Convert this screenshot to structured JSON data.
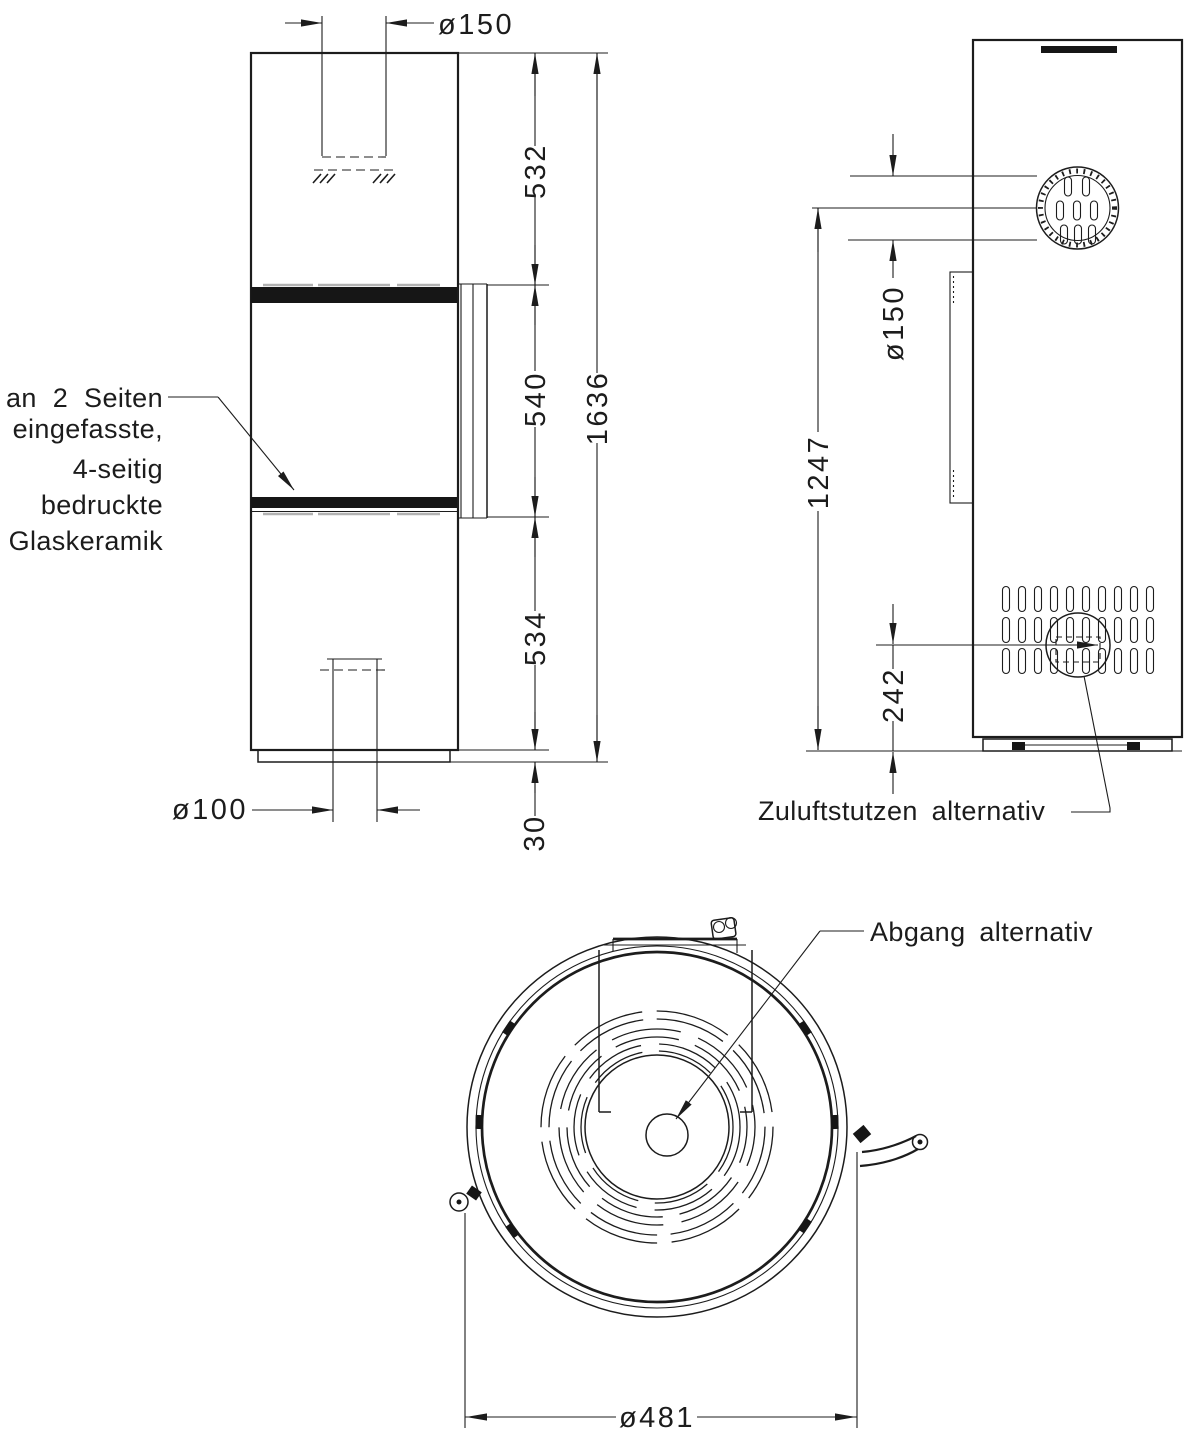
{
  "front_view": {
    "glass_note": [
      "an 2 Seiten",
      "eingefasste,",
      "4-seitig",
      "bedruckte",
      "Glaskeramik"
    ],
    "dim_flue_diameter": "ø150",
    "dim_upper_section": "532",
    "dim_window_height": "540",
    "dim_lower_section": "534",
    "dim_base_height": "30",
    "dim_total_height": "1636",
    "dim_air_inlet_diameter": "ø100"
  },
  "side_view": {
    "dim_flue_diameter": "ø150",
    "dim_flue_center_height": "1247",
    "dim_inlet_center_height": "242",
    "label_air_inlet": "Zuluftstutzen alternativ"
  },
  "top_view": {
    "label_flue_outlet": "Abgang alternativ",
    "dim_outer_diameter": "ø481"
  },
  "colors": {
    "line": "#1c1c1c",
    "hidden_line": "#b2b2b2",
    "background": "#ffffff"
  }
}
